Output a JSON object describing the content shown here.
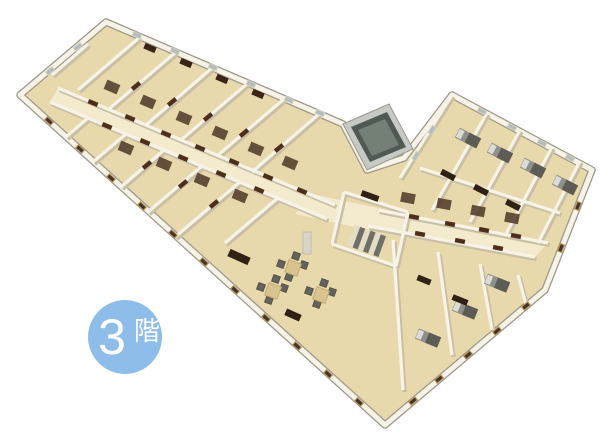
{
  "page": {
    "background": "#ffffff",
    "width": 600,
    "height": 440
  },
  "badge": {
    "number": "3",
    "suffix": "階",
    "label": "3階",
    "bg_color": "#8FBDE9",
    "text_color": "#FFFFFF",
    "cx": 125,
    "cy": 337,
    "r": 37
  },
  "scene": {
    "type": "isometric-3d-floorplan-render",
    "description": "3D rendered bird's-eye floor plan of the 3rd floor of a V-shaped building with two wings of small rooms along central corridors, a lounge with tables and chairs at the junction, a staircase and an elevator shaft",
    "colors": {
      "floor": "#E8D9AC",
      "floor_corridor": "#F4EACD",
      "wall": "#F7F3E6",
      "wall_shadow": "#C8BFA5",
      "outer_rim": "#9B978C",
      "door": "#4D2E1B",
      "bath": "#513B2A",
      "window_dark": "#3F362B",
      "window_frame": "#BE9257",
      "window_light": "#AEBDC6",
      "window_frame_light": "#D8CFB4",
      "bed": "#90908A",
      "bed_dark": "#5C5C55",
      "bed_light": "#DCDCD6",
      "desk": "#2F2114",
      "cabinet": "#3A2417",
      "table": "#D9C48F",
      "table_edge": "#C0AB72",
      "chair": "#63635C",
      "stairs_light": "#E3DCC6",
      "stairs_dark": "#6F6F68",
      "elevator_wall": "#C6CAC4",
      "elevator_core": "#505A53",
      "elevator_inner": "#747F76",
      "column": "#D8D4C8"
    },
    "outline": [
      [
        106,
        22
      ],
      [
        343,
        124
      ],
      [
        367,
        170
      ],
      [
        404,
        158
      ],
      [
        452,
        95
      ],
      [
        592,
        170
      ],
      [
        545,
        290
      ],
      [
        385,
        425
      ],
      [
        20,
        95
      ]
    ],
    "corridors": [
      [
        [
          58,
          88
        ],
        [
          335,
          205
        ],
        [
          327,
          219
        ],
        [
          50,
          102
        ]
      ],
      [
        [
          378,
          210
        ],
        [
          548,
          243
        ],
        [
          535,
          257
        ],
        [
          368,
          226
        ]
      ],
      [
        [
          302,
          192
        ],
        [
          378,
          208
        ],
        [
          368,
          230
        ],
        [
          296,
          214
        ]
      ]
    ],
    "walls": [
      [
        140,
        37,
        78,
        90
      ],
      [
        176,
        52,
        109,
        109
      ],
      [
        212,
        68,
        146,
        125
      ],
      [
        248,
        83,
        181,
        140
      ],
      [
        284,
        99,
        217,
        156
      ],
      [
        319,
        114,
        252,
        172
      ],
      [
        88,
        118,
        66,
        137
      ],
      [
        126,
        134,
        93,
        162
      ],
      [
        164,
        150,
        121,
        187
      ],
      [
        202,
        166,
        148,
        212
      ],
      [
        240,
        182,
        175,
        237
      ],
      [
        278,
        198,
        225,
        243
      ],
      [
        58,
        88,
        335,
        205
      ],
      [
        50,
        102,
        327,
        219
      ],
      [
        88,
        44,
        52,
        75
      ],
      [
        344,
        192,
        408,
        212
      ],
      [
        408,
        212,
        396,
        266
      ],
      [
        332,
        244,
        396,
        266
      ],
      [
        344,
        192,
        332,
        244
      ],
      [
        378,
        210,
        548,
        243
      ],
      [
        368,
        226,
        535,
        257
      ],
      [
        420,
        168,
        560,
        213
      ],
      [
        487,
        113,
        432,
        210
      ],
      [
        520,
        130,
        470,
        222
      ],
      [
        552,
        147,
        506,
        234
      ],
      [
        580,
        161,
        538,
        243
      ],
      [
        452,
        95,
        400,
        178
      ],
      [
        393,
        240,
        403,
        390
      ],
      [
        438,
        252,
        452,
        355
      ],
      [
        480,
        264,
        492,
        330
      ],
      [
        518,
        275,
        526,
        305
      ]
    ],
    "doors": [
      [
        93,
        103,
        23
      ],
      [
        130,
        118,
        23
      ],
      [
        166,
        134,
        23
      ],
      [
        200,
        148,
        23
      ],
      [
        234,
        162,
        23
      ],
      [
        268,
        177,
        23
      ],
      [
        302,
        191,
        23
      ],
      [
        107,
        126,
        23
      ],
      [
        145,
        142,
        23
      ],
      [
        183,
        158,
        23
      ],
      [
        221,
        174,
        23
      ],
      [
        259,
        190,
        23
      ],
      [
        136,
        86,
        -40
      ],
      [
        172,
        102,
        -40
      ],
      [
        208,
        117,
        -40
      ],
      [
        244,
        133,
        -40
      ],
      [
        279,
        148,
        -40
      ],
      [
        147,
        165,
        -40
      ],
      [
        183,
        184,
        -40
      ],
      [
        214,
        204,
        -40
      ],
      [
        414,
        217,
        11
      ],
      [
        450,
        224,
        11
      ],
      [
        484,
        230,
        11
      ],
      [
        516,
        236,
        11
      ],
      [
        420,
        234,
        11
      ],
      [
        460,
        241,
        11
      ],
      [
        498,
        248,
        11
      ]
    ],
    "baths": [
      [
        112,
        87,
        23
      ],
      [
        148,
        102,
        23
      ],
      [
        184,
        118,
        23
      ],
      [
        220,
        133,
        23
      ],
      [
        256,
        149,
        23
      ],
      [
        290,
        163,
        23
      ],
      [
        126,
        148,
        23
      ],
      [
        164,
        164,
        23
      ],
      [
        202,
        180,
        23
      ],
      [
        240,
        196,
        23
      ],
      [
        408,
        198,
        11
      ],
      [
        444,
        204,
        11
      ],
      [
        478,
        211,
        11
      ],
      [
        512,
        218,
        11
      ]
    ],
    "windows_dark": [
      [
        49,
        121,
        42
      ],
      [
        80,
        149,
        42
      ],
      [
        111,
        178,
        42
      ],
      [
        142,
        206,
        42
      ],
      [
        173,
        234,
        42
      ],
      [
        204,
        262,
        42
      ],
      [
        235,
        290,
        42
      ],
      [
        266,
        318,
        42
      ],
      [
        297,
        346,
        42
      ],
      [
        328,
        374,
        42
      ],
      [
        359,
        402,
        42
      ],
      [
        578,
        206,
        111
      ],
      [
        561,
        248,
        111
      ],
      [
        526,
        306,
        140
      ],
      [
        497,
        331,
        140
      ],
      [
        468,
        355,
        140
      ],
      [
        439,
        379,
        140
      ],
      [
        413,
        401,
        140
      ]
    ],
    "windows_light": [
      [
        137,
        35,
        23
      ],
      [
        175,
        51,
        23
      ],
      [
        213,
        67,
        23
      ],
      [
        251,
        84,
        23
      ],
      [
        289,
        100,
        23
      ],
      [
        320,
        113,
        23
      ],
      [
        482,
        111,
        28
      ],
      [
        512,
        127,
        28
      ],
      [
        542,
        143,
        28
      ],
      [
        570,
        158,
        28
      ],
      [
        50,
        71,
        -40
      ],
      [
        78,
        47,
        -40
      ],
      [
        432,
        130,
        -58
      ],
      [
        416,
        156,
        -58
      ]
    ],
    "beds": [
      [
        468,
        138,
        27
      ],
      [
        500,
        153,
        27
      ],
      [
        533,
        168,
        27
      ],
      [
        565,
        185,
        27
      ],
      [
        428,
        338,
        22
      ],
      [
        465,
        310,
        22
      ],
      [
        497,
        283,
        22
      ]
    ],
    "desks": [
      [
        448,
        175,
        27,
        15,
        6
      ],
      [
        481,
        190,
        27,
        15,
        6
      ],
      [
        513,
        205,
        27,
        15,
        6
      ],
      [
        460,
        300,
        22,
        16,
        6
      ],
      [
        424,
        280,
        22,
        14,
        6
      ],
      [
        370,
        196,
        20,
        18,
        6
      ],
      [
        239,
        257,
        24,
        22,
        8
      ],
      [
        293,
        315,
        24,
        16,
        7
      ]
    ],
    "cabinets": [
      [
        150,
        48,
        23
      ],
      [
        186,
        63,
        23
      ],
      [
        222,
        79,
        23
      ],
      [
        258,
        94,
        23
      ]
    ],
    "tables": [
      [
        293,
        268
      ],
      [
        273,
        291
      ],
      [
        321,
        295
      ]
    ],
    "chair_offsets": [
      [
        -12,
        -4
      ],
      [
        11,
        -3
      ],
      [
        -4,
        9
      ],
      [
        3,
        -12
      ]
    ],
    "stairs": {
      "x": 355,
      "y": 225,
      "rot": 20,
      "steps": 6,
      "step_w": 5.5,
      "step_h": 22
    },
    "elevator": {
      "outer": [
        [
          343,
          124
        ],
        [
          389,
          104
        ],
        [
          413,
          149
        ],
        [
          367,
          170
        ]
      ],
      "core": [
        [
          351,
          127
        ],
        [
          387,
          112
        ],
        [
          406,
          147
        ],
        [
          370,
          162
        ]
      ],
      "inner": [
        [
          358,
          130
        ],
        [
          385,
          119
        ],
        [
          399,
          145
        ],
        [
          372,
          156
        ]
      ]
    },
    "column": {
      "x": 303,
      "y": 232,
      "w": 8,
      "h": 22
    }
  }
}
